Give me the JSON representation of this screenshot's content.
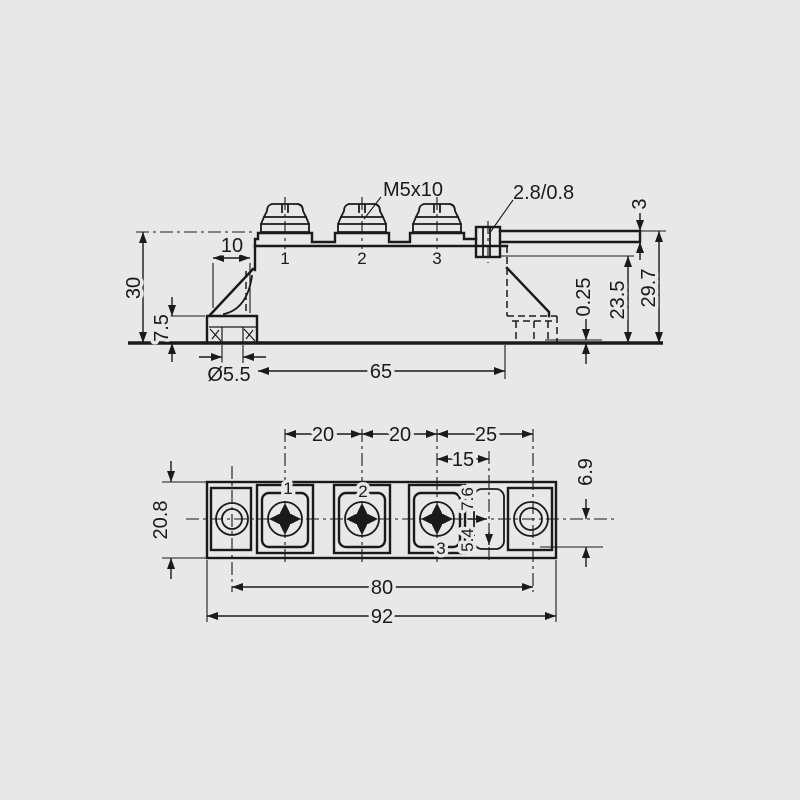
{
  "drawing": {
    "title": "power-module-dimension-drawing",
    "background_color": "#e8e8e8",
    "line_color": "#1a1a1a"
  },
  "side_view": {
    "thread_label": "M5x10",
    "tab_size_label": "2.8/0.8",
    "terminals": {
      "t1": "1",
      "t2": "2",
      "t3": "3"
    },
    "dims": {
      "total_height": "30",
      "foot_width": "10",
      "foot_height": "7.5",
      "slot_diameter": "Ø5.5",
      "slot_span": "65",
      "standoff": "0.25",
      "tab_underside_height": "23.5",
      "tab_top_height": "29.7",
      "tab_step": "3"
    }
  },
  "top_view": {
    "terminals": {
      "t1": "1",
      "t2": "2",
      "t3": "3"
    },
    "dims": {
      "pitch_1_2": "20",
      "pitch_2_3": "20",
      "pitch_3_hole": "25",
      "tab_offset": "15",
      "body_width": "20.8",
      "hole_spacing": "80",
      "overall_length": "92",
      "tab_center_offset": "6.9",
      "tab_width_a": "5.4",
      "tab_width_b": "7.6"
    }
  }
}
